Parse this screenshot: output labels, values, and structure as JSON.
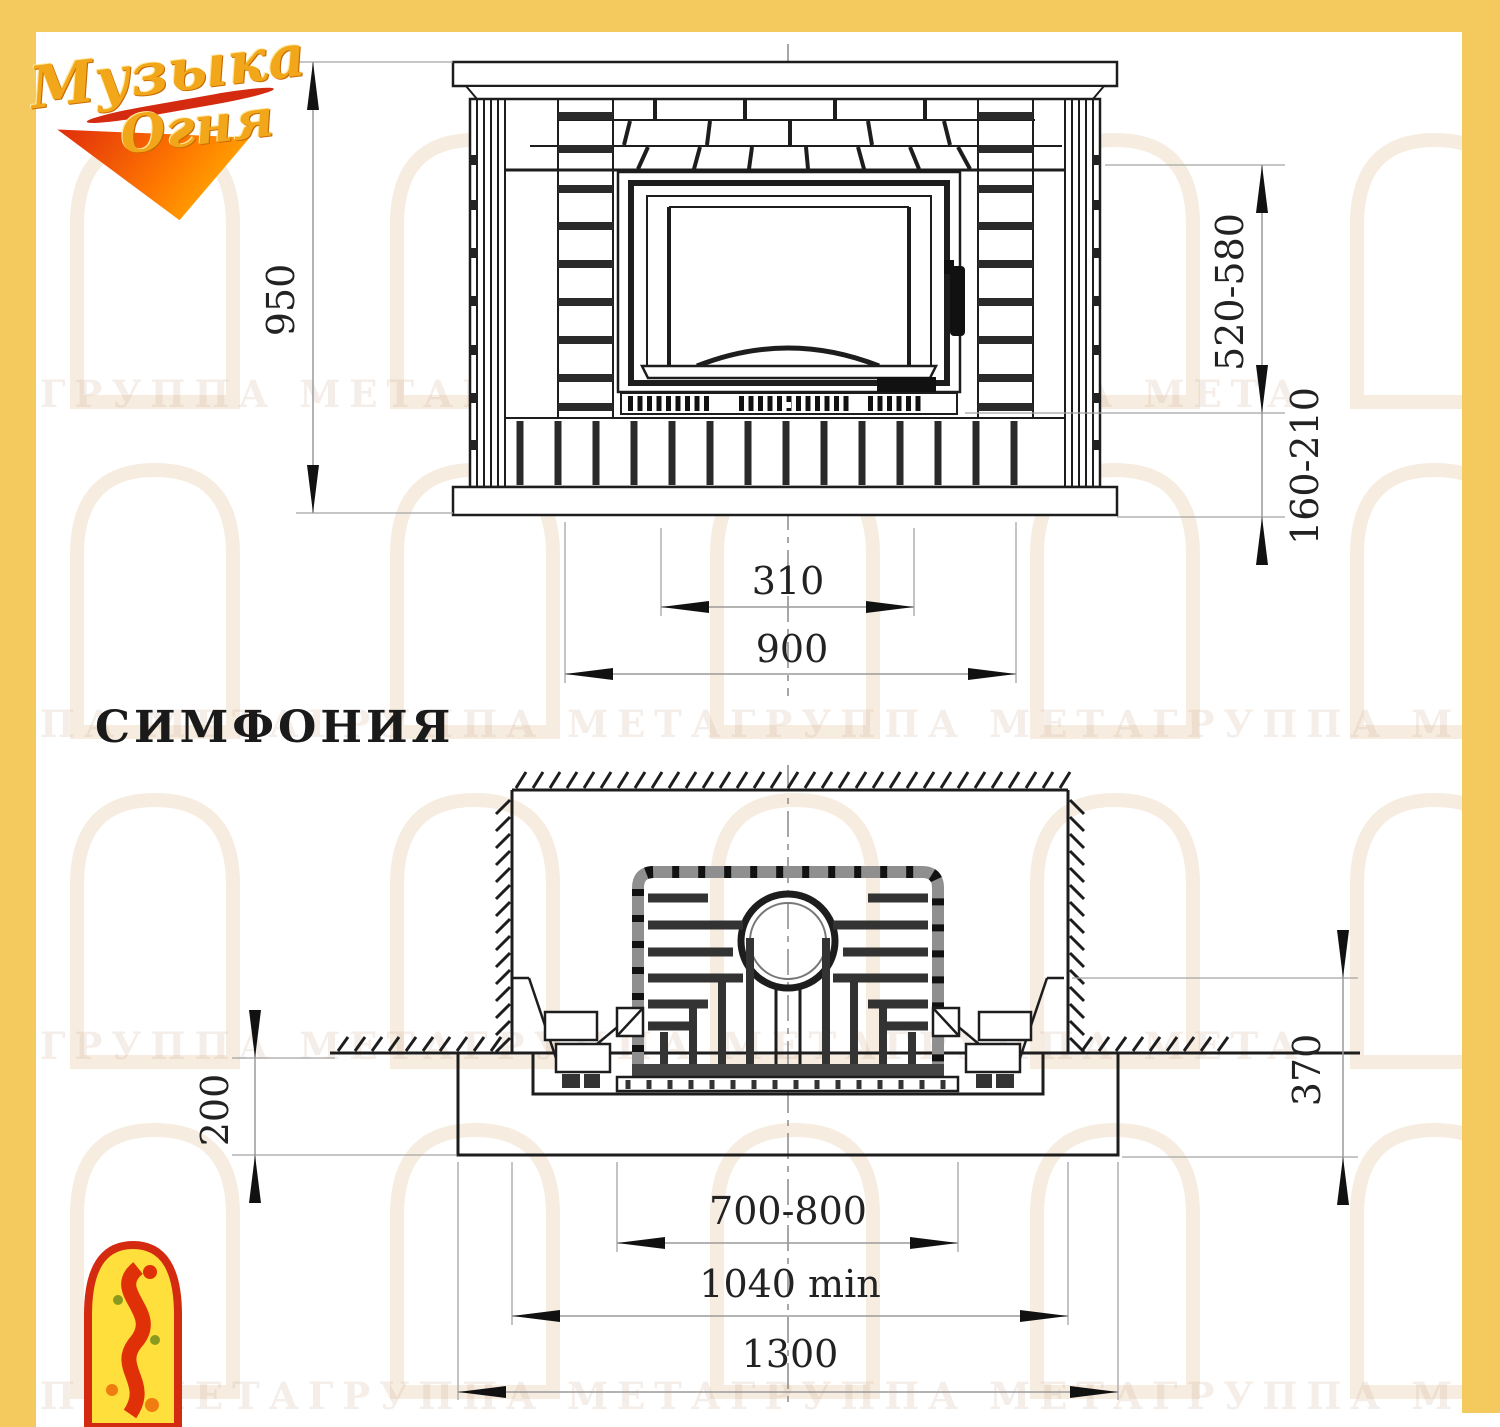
{
  "brand": {
    "logo_line1": "Музыка",
    "logo_line2": "Огня"
  },
  "model": {
    "title": "СИМФОНИЯ"
  },
  "front_view": {
    "label_height": "950",
    "label_firebox_to_mantel": "520-580",
    "label_firebox_to_floor": "160-210",
    "label_grille_width": "310",
    "label_body_width": "900"
  },
  "plan_view": {
    "label_foundation_depth": "200",
    "label_hearth_height": "370",
    "label_insert_width": "700-800",
    "label_niche_width": "1040 min",
    "label_foundation_width": "1300"
  },
  "watermark": {
    "row1": "ГРУППА МЕТАГРУППА МЕТАГРУППА МЕТА",
    "row2": "ПА МЕТАГРУППА МЕТАГРУППА МЕТАГРУППА МЕТА",
    "row3": "ГРУППА МЕТАГРУППА МЕТАГРУППА МЕТА",
    "row4": "ПА МЕТАГРУППА МЕТАГРУППА МЕТАГРУППА МЕ"
  },
  "colors": {
    "frame_yellow": "#f4c95d",
    "line_black": "#1d1d1d",
    "dim_grey": "#9a9a9a",
    "emblem_red": "#d42a10",
    "emblem_yellow": "#ffdf3c",
    "logo_gold": "#f2a71b"
  }
}
